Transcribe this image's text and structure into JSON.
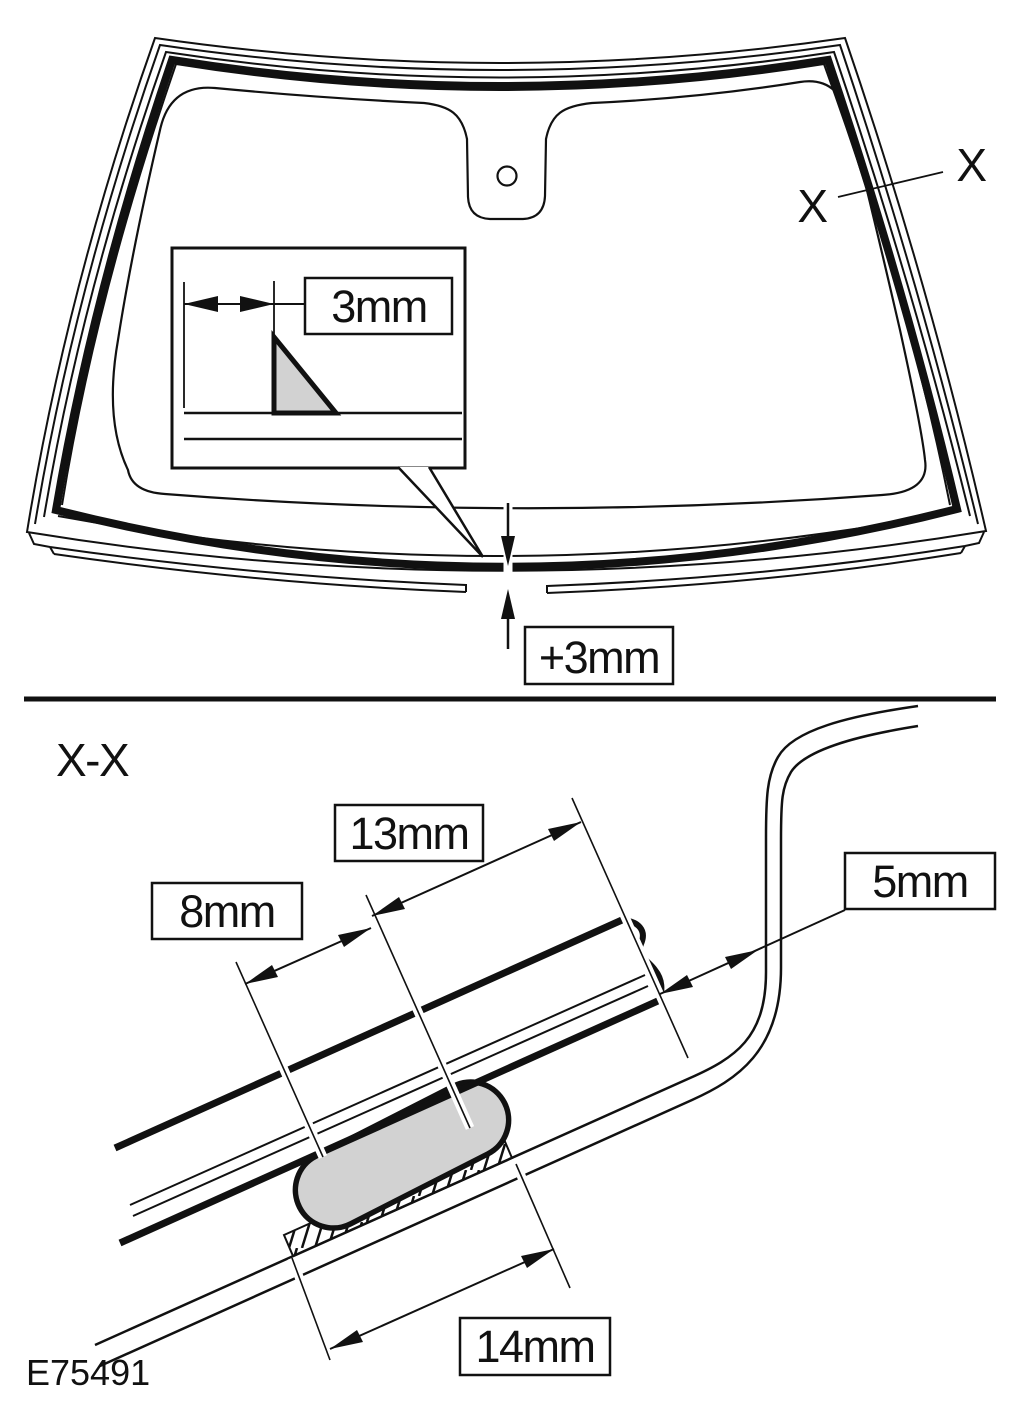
{
  "drawing": {
    "code": "E75491",
    "colors": {
      "line": "#111111",
      "bead_fill": "#d2d2d2",
      "background": "#ffffff"
    },
    "top_view": {
      "section_marker_outer": "X",
      "section_marker_inner": "X",
      "detail_dimension": "3mm",
      "flush_dimension": "+3mm"
    },
    "section_view": {
      "title": "X-X",
      "glass_edge_to_bead": "13mm",
      "bead_width": "8mm",
      "glass_to_panel_gap": "5mm",
      "bead_base_width": "14mm"
    }
  }
}
